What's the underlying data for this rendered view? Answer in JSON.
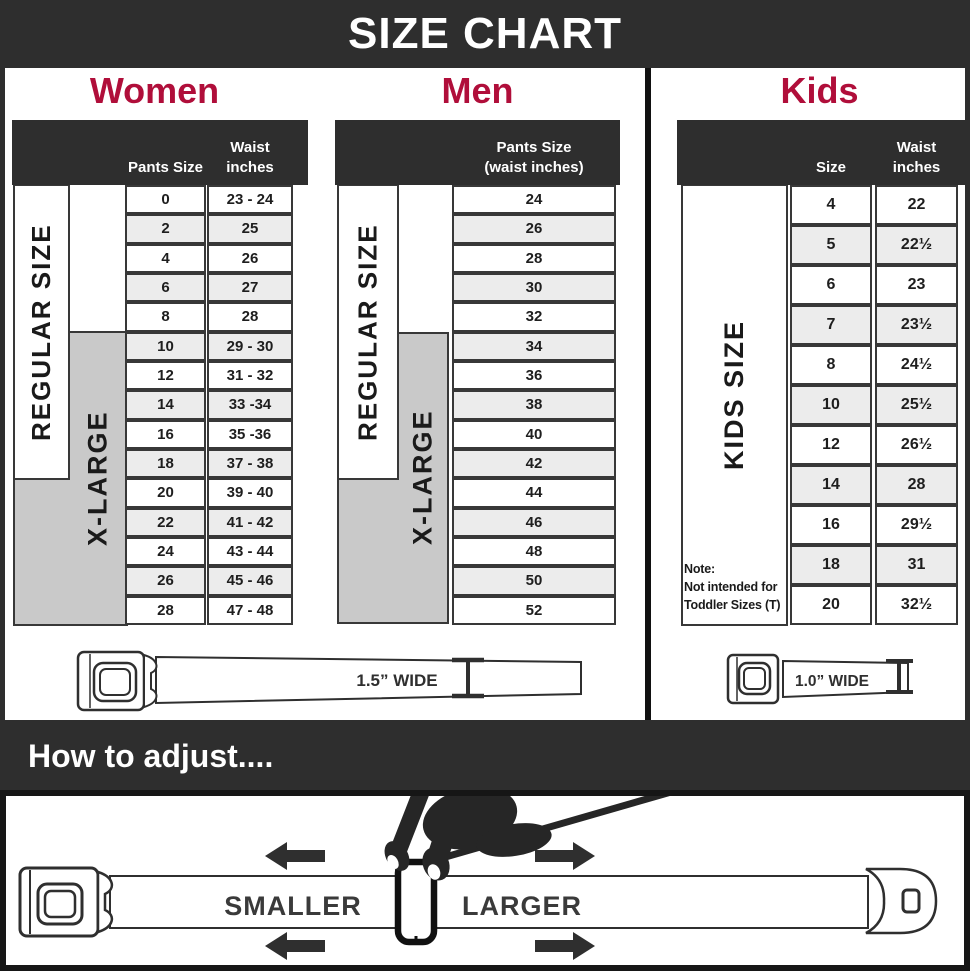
{
  "page": {
    "title": "SIZE CHART"
  },
  "colors": {
    "dark": "#2e2e2e",
    "accent": "#b00e3a",
    "row_alt": "#ececec",
    "box_gray": "#c9c9c9"
  },
  "women": {
    "title": "Women",
    "columns": {
      "col1": "Pants Size",
      "col2_line1": "Waist",
      "col2_line2": "inches"
    },
    "regular_label": "REGULAR SIZE",
    "xlarge_label": "X-LARGE",
    "rows": [
      {
        "size": "0",
        "waist": "23 - 24"
      },
      {
        "size": "2",
        "waist": "25"
      },
      {
        "size": "4",
        "waist": "26"
      },
      {
        "size": "6",
        "waist": "27"
      },
      {
        "size": "8",
        "waist": "28"
      },
      {
        "size": "10",
        "waist": "29 - 30"
      },
      {
        "size": "12",
        "waist": "31 - 32"
      },
      {
        "size": "14",
        "waist": "33 -34"
      },
      {
        "size": "16",
        "waist": "35 -36"
      },
      {
        "size": "18",
        "waist": "37 - 38"
      },
      {
        "size": "20",
        "waist": "39 - 40"
      },
      {
        "size": "22",
        "waist": "41 - 42"
      },
      {
        "size": "24",
        "waist": "43 - 44"
      },
      {
        "size": "26",
        "waist": "45 - 46"
      },
      {
        "size": "28",
        "waist": "47 - 48"
      }
    ],
    "belt_width_label": "1.5” WIDE"
  },
  "men": {
    "title": "Men",
    "header_line1": "Pants Size",
    "header_line2": "(waist inches)",
    "regular_label": "REGULAR SIZE",
    "xlarge_label": "X-LARGE",
    "rows": [
      "24",
      "26",
      "28",
      "30",
      "32",
      "34",
      "36",
      "38",
      "40",
      "42",
      "44",
      "46",
      "48",
      "50",
      "52"
    ]
  },
  "kids": {
    "title": "Kids",
    "columns": {
      "col1": "Size",
      "col2_line1": "Waist",
      "col2_line2": "inches"
    },
    "label": "KIDS SIZE",
    "note": {
      "line1": "Note:",
      "line2": "Not intended for",
      "line3": "Toddler Sizes (T)"
    },
    "rows": [
      {
        "size": "4",
        "waist": "22"
      },
      {
        "size": "5",
        "waist": "22½"
      },
      {
        "size": "6",
        "waist": "23"
      },
      {
        "size": "7",
        "waist": "23½"
      },
      {
        "size": "8",
        "waist": "24½"
      },
      {
        "size": "10",
        "waist": "25½"
      },
      {
        "size": "12",
        "waist": "26½"
      },
      {
        "size": "14",
        "waist": "28"
      },
      {
        "size": "16",
        "waist": "29½"
      },
      {
        "size": "18",
        "waist": "31"
      },
      {
        "size": "20",
        "waist": "32½"
      }
    ],
    "belt_width_label": "1.0” WIDE"
  },
  "how_to": {
    "title": "How to adjust....",
    "smaller_label": "SMALLER",
    "larger_label": "LARGER"
  }
}
